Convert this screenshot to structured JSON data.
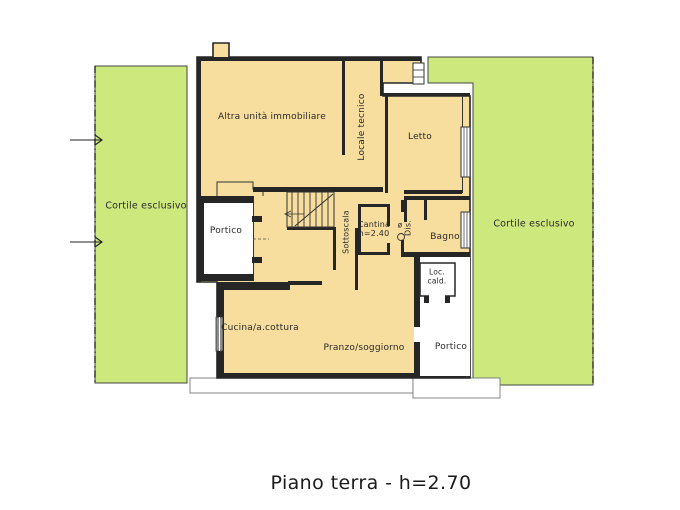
{
  "plan": {
    "type": "floor-plan",
    "caption": "Piano terra - h=2.70",
    "colors": {
      "courtyard_green": "#cde97d",
      "building_fill": "#f7dd9e",
      "wall_dark": "#262626",
      "thin_line": "#444444",
      "window_gray": "#8f8f8f"
    },
    "labels": {
      "cortile_left": "Cortile esclusivo",
      "cortile_right": "Cortile esclusivo",
      "altra_unita": "Altra unità immobiliare",
      "locale_tecnico": "Locale tecnico",
      "letto": "Letto",
      "portico_left": "Portico",
      "sottoscala": "Sottoscala",
      "cantina_line1": "Cantina",
      "cantina_line2": "h=2.40",
      "dis": "Dis.",
      "flue_symbol": "ø",
      "bagno": "Bagno",
      "loc_cald_line1": "Loc.",
      "loc_cald_line2": "cald.",
      "cucina": "Cucina/a.cottura",
      "pranzo": "Pranzo/soggiorno",
      "portico_right": "Portico",
      "caption": "Piano terra - h=2.70"
    }
  }
}
